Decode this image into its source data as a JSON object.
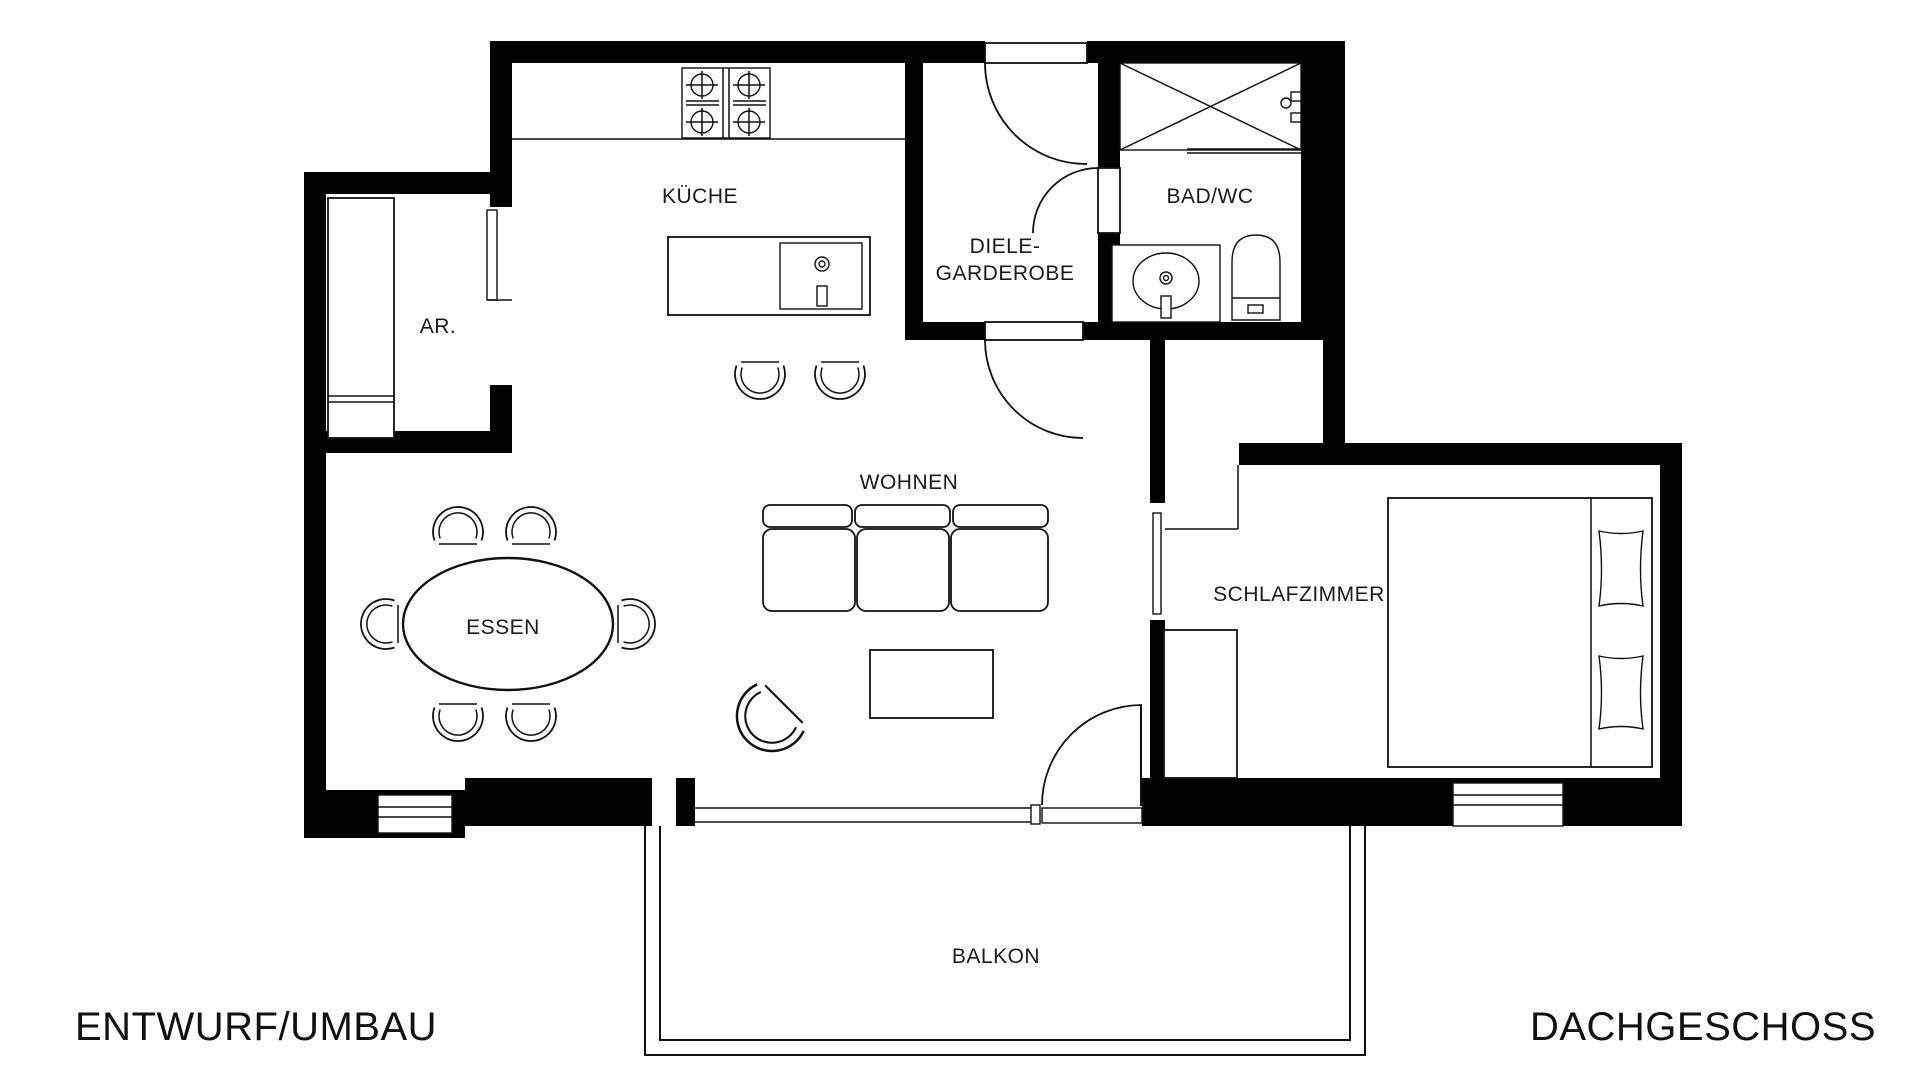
{
  "plan_type": "floor-plan",
  "footer": {
    "left": "ENTWURF/UMBAU",
    "right": "DACHGESCHOSS"
  },
  "rooms": {
    "kitchen": {
      "label": "KÜCHE"
    },
    "storage": {
      "label": "AR."
    },
    "hall": {
      "label_line1": "DIELE-",
      "label_line2": "GARDEROBE"
    },
    "bath": {
      "label": "BAD/WC"
    },
    "living": {
      "label": "WOHNEN"
    },
    "dining": {
      "label": "ESSEN"
    },
    "bedroom": {
      "label": "SCHLAFZIMMER"
    },
    "balcony": {
      "label": "BALKON"
    }
  },
  "colors": {
    "wall": "#000000",
    "line": "#111111",
    "background": "#ffffff",
    "text": "#1a1a1a"
  },
  "furniture": {
    "kitchen": [
      "stove",
      "counter",
      "island",
      "island-sink",
      "bar-stools"
    ],
    "bath": [
      "shower",
      "shower-fixture",
      "vanity-sink",
      "toilet"
    ],
    "living": [
      "sofa",
      "coffee-table",
      "armchair"
    ],
    "dining": [
      "oval-table",
      "six-chairs"
    ],
    "bedroom": [
      "double-bed",
      "pillows",
      "wardrobe"
    ],
    "storage": [
      "closet"
    ]
  }
}
